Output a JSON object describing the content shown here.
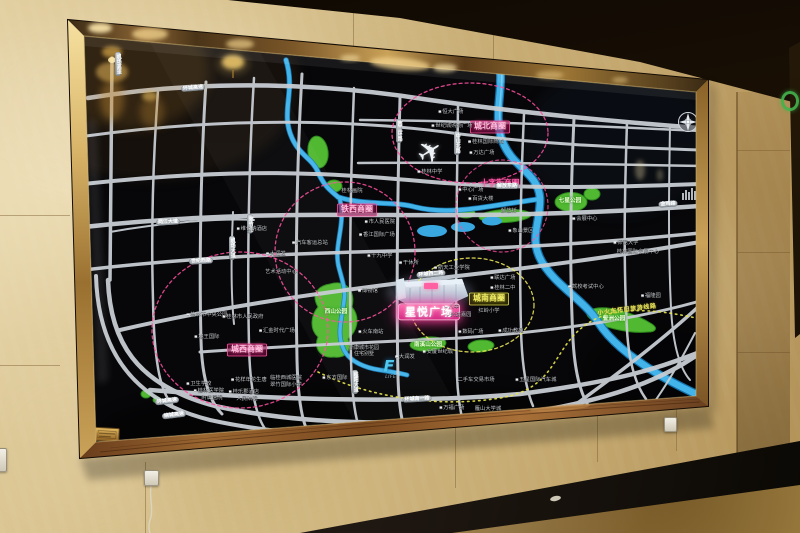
{
  "palette": {
    "accent_pink": "#ff4fa0",
    "accent_yellow": "#e8e44a",
    "road_gray": "#c7cdd3",
    "river_blue": "#43b4ea",
    "park_green": "#55c234",
    "frame_gold": "#caa258",
    "wall_marble": "#d0b780"
  },
  "board": {
    "labels": [
      {
        "t": "城北商圈",
        "x": 490,
        "y": 127,
        "s": "pink"
      },
      {
        "t": "铁西商圈",
        "x": 357,
        "y": 210,
        "s": "pink"
      },
      {
        "t": "城西商圈",
        "x": 247,
        "y": 350,
        "s": "pink"
      },
      {
        "t": "城南商圈",
        "x": 489,
        "y": 299,
        "s": "yellow"
      },
      {
        "t": "十字街商圈",
        "x": 500,
        "y": 184,
        "s": "pinktext"
      },
      {
        "t": "星悦广场",
        "x": 429,
        "y": 312,
        "s": "plaza"
      },
      {
        "t": "小火车怀旧旅游线路",
        "x": 627,
        "y": 310,
        "s": "yellowtext",
        "r": -7
      },
      {
        "t": "环城高速",
        "x": 193,
        "y": 88,
        "s": "pill",
        "r": -5
      },
      {
        "t": "机场高速",
        "x": 118,
        "y": 64,
        "s": "pillv"
      },
      {
        "t": "两江大道",
        "x": 168,
        "y": 222,
        "s": "pill",
        "r": -3
      },
      {
        "t": "翠竹路",
        "x": 250,
        "y": 224,
        "s": "pillv"
      },
      {
        "t": "机场大道",
        "x": 232,
        "y": 248,
        "s": "pillv"
      },
      {
        "t": "世纪西路",
        "x": 201,
        "y": 261,
        "s": "pill",
        "r": -3
      },
      {
        "t": "西二环路",
        "x": 399,
        "y": 131,
        "s": "pillv"
      },
      {
        "t": "中山北路",
        "x": 457,
        "y": 143,
        "s": "pillv"
      },
      {
        "t": "环城西二路",
        "x": 431,
        "y": 274,
        "s": "pill",
        "r": -5
      },
      {
        "t": "解放东路",
        "x": 507,
        "y": 186,
        "s": "pill"
      },
      {
        "t": "桂阳大道",
        "x": 355,
        "y": 382,
        "s": "pillv"
      },
      {
        "t": "环城南一路",
        "x": 417,
        "y": 399,
        "s": "pill",
        "r": -3
      },
      {
        "t": "环城高速",
        "x": 167,
        "y": 401,
        "s": "pill",
        "r": -7
      },
      {
        "t": "绕城高速",
        "x": 174,
        "y": 415,
        "s": "pill",
        "r": -7
      },
      {
        "t": "金鸡路",
        "x": 668,
        "y": 204,
        "s": "pill",
        "r": -4
      },
      {
        "t": "恒大广场",
        "x": 451,
        "y": 112,
        "s": "poi",
        "i": 1
      },
      {
        "t": "世纪城购物广场",
        "x": 452,
        "y": 126,
        "s": "poi",
        "i": 1
      },
      {
        "t": "桂林国际商城",
        "x": 486,
        "y": 142,
        "s": "poi",
        "i": 1
      },
      {
        "t": "万达广场",
        "x": 482,
        "y": 153,
        "s": "poi",
        "i": 1
      },
      {
        "t": "桂林中学",
        "x": 430,
        "y": 172,
        "s": "poi",
        "i": 1
      },
      {
        "t": "桂林画院",
        "x": 352,
        "y": 191,
        "s": "poi"
      },
      {
        "t": "市人民医院",
        "x": 380,
        "y": 222,
        "s": "poi",
        "i": 1
      },
      {
        "t": "香江国际广场",
        "x": 377,
        "y": 235,
        "s": "poi",
        "i": 1
      },
      {
        "t": "十九中学",
        "x": 380,
        "y": 256,
        "s": "poi",
        "i": 1
      },
      {
        "t": "维也纳酒店",
        "x": 252,
        "y": 229,
        "s": "poi",
        "i": 1
      },
      {
        "t": "大润发",
        "x": 276,
        "y": 254,
        "s": "poi",
        "i": 1
      },
      {
        "t": "汽车客运总站",
        "x": 310,
        "y": 243,
        "s": "poi",
        "i": 1
      },
      {
        "t": "艺术活动中心",
        "x": 281,
        "y": 272,
        "s": "poi"
      },
      {
        "t": "中心广场",
        "x": 471,
        "y": 190,
        "s": "poi",
        "i": 1
      },
      {
        "t": "百货大楼",
        "x": 481,
        "y": 199,
        "s": "poi",
        "i": 1
      },
      {
        "t": "解放桥",
        "x": 509,
        "y": 211,
        "s": "poi"
      },
      {
        "t": "象山景区",
        "x": 521,
        "y": 231,
        "s": "poi",
        "i": 1
      },
      {
        "t": "会展中心",
        "x": 585,
        "y": 219,
        "s": "poi",
        "i": 1
      },
      {
        "t": "师范大学",
        "x": 626,
        "y": 243,
        "s": "poi",
        "i": 1
      },
      {
        "t": "桂林国际会展中心",
        "x": 638,
        "y": 252,
        "s": "poi"
      },
      {
        "t": "驾校考试中心",
        "x": 586,
        "y": 287,
        "s": "poi",
        "i": 1
      },
      {
        "t": "福隆园",
        "x": 651,
        "y": 296,
        "s": "poi",
        "i": 1
      },
      {
        "t": "桂林市中央公园",
        "x": 207,
        "y": 315,
        "s": "poi",
        "i": 1
      },
      {
        "t": "桂林市人民政府",
        "x": 243,
        "y": 317,
        "s": "poi",
        "i": 1
      },
      {
        "t": "汇金时代广场",
        "x": 277,
        "y": 331,
        "s": "poi",
        "i": 1
      },
      {
        "t": "地王国际",
        "x": 207,
        "y": 337,
        "s": "poi",
        "i": 1
      },
      {
        "t": "卫生学校",
        "x": 199,
        "y": 384,
        "s": "poi",
        "i": 1
      },
      {
        "t": "桂林医学院",
        "x": 209,
        "y": 391,
        "s": "poi",
        "i": 1
      },
      {
        "t": "附属医院",
        "x": 212,
        "y": 398,
        "s": "poi"
      },
      {
        "t": "干休所",
        "x": 409,
        "y": 263,
        "s": "poi",
        "i": 1
      },
      {
        "t": "航天工业学院",
        "x": 452,
        "y": 268,
        "s": "poi",
        "i": 1
      },
      {
        "t": "联达广场",
        "x": 503,
        "y": 278,
        "s": "poi",
        "i": 1
      },
      {
        "t": "桂林二中",
        "x": 503,
        "y": 288,
        "s": "poi",
        "i": 1
      },
      {
        "t": "八中",
        "x": 452,
        "y": 307,
        "s": "poi",
        "i": 1
      },
      {
        "t": "兴进嘉园",
        "x": 459,
        "y": 315,
        "s": "poi",
        "i": 1
      },
      {
        "t": "红岭小学",
        "x": 489,
        "y": 311,
        "s": "poi"
      },
      {
        "t": "数码广场",
        "x": 471,
        "y": 332,
        "s": "poi",
        "i": 1
      },
      {
        "t": "成功教苑",
        "x": 511,
        "y": 331,
        "s": "poi",
        "i": 1
      },
      {
        "t": "博物馆",
        "x": 368,
        "y": 291,
        "s": "poi",
        "i": 1
      },
      {
        "t": "火车南站",
        "x": 371,
        "y": 332,
        "s": "poi",
        "i": 1
      },
      {
        "t": "新康城市花园\n住宅别墅",
        "x": 364,
        "y": 351,
        "s": "poi2"
      },
      {
        "t": "大润发",
        "x": 405,
        "y": 357,
        "s": "poi",
        "i": 1
      },
      {
        "t": "东方国际",
        "x": 335,
        "y": 378,
        "s": "poi",
        "i": 1
      },
      {
        "t": "花样年花生唐",
        "x": 249,
        "y": 380,
        "s": "poi",
        "i": 1
      },
      {
        "t": "临桂西城医院",
        "x": 286,
        "y": 378,
        "s": "poi"
      },
      {
        "t": "翠竹国际小学",
        "x": 286,
        "y": 385,
        "s": "poi"
      },
      {
        "t": "桂乐郡酒店",
        "x": 244,
        "y": 392,
        "s": "poi",
        "i": 1
      },
      {
        "t": "人民法院",
        "x": 247,
        "y": 399,
        "s": "poi"
      },
      {
        "t": "安厦世纪城",
        "x": 438,
        "y": 352,
        "s": "poi",
        "i": 1
      },
      {
        "t": "二手车交易市场",
        "x": 476,
        "y": 380,
        "s": "poi"
      },
      {
        "t": "五星国际汽车城",
        "x": 536,
        "y": 380,
        "s": "poi",
        "i": 1
      },
      {
        "t": "万福广场",
        "x": 452,
        "y": 408,
        "s": "poi",
        "i": 1
      },
      {
        "t": "雁山大学城",
        "x": 488,
        "y": 409,
        "s": "poi"
      },
      {
        "t": "七星公园",
        "x": 570,
        "y": 201,
        "s": "green"
      },
      {
        "t": "西山公园",
        "x": 336,
        "y": 312,
        "s": "green"
      },
      {
        "t": "南溪山公园",
        "x": 428,
        "y": 345,
        "s": "green"
      },
      {
        "t": "訾洲公园",
        "x": 614,
        "y": 319,
        "s": "green"
      },
      {
        "t": "F",
        "x": 389,
        "y": 366,
        "s": "logoF"
      },
      {
        "t": "LIFE!!",
        "x": 393,
        "y": 377,
        "s": "logotext"
      }
    ]
  }
}
